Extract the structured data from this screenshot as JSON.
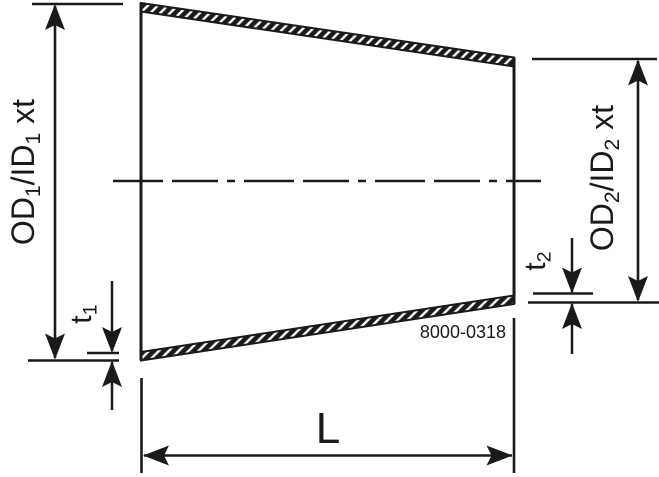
{
  "diagram": {
    "kind": "technical-drawing-concentric-reducer",
    "colors": {
      "line": "#1a1a1a",
      "background": "#ffffff"
    },
    "labels": {
      "od1_parts": [
        {
          "t": "OD"
        },
        {
          "t": "1",
          "sub": true
        },
        {
          "t": "/ID"
        },
        {
          "t": "1",
          "sub": true
        },
        {
          "t": " xt"
        }
      ],
      "od2_parts": [
        {
          "t": "OD"
        },
        {
          "t": "2",
          "sub": true
        },
        {
          "t": "/ID"
        },
        {
          "t": "2",
          "sub": true
        },
        {
          "t": " xt"
        }
      ],
      "t1_parts": [
        {
          "t": "t"
        },
        {
          "t": "1",
          "sub": true
        }
      ],
      "t2_parts": [
        {
          "t": "t"
        },
        {
          "t": "2",
          "sub": true
        }
      ],
      "length": "L",
      "drawing_number": "8000-0318"
    }
  }
}
